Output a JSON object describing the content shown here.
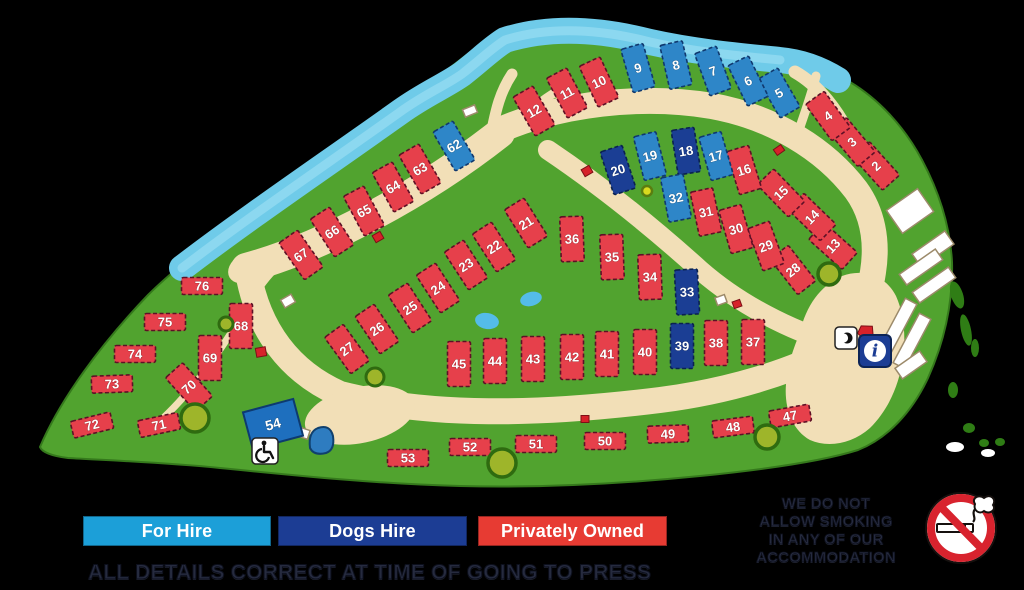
{
  "legend": {
    "items": [
      {
        "label": "For Hire",
        "chip_color": "#1C9FD8",
        "type": "forhire"
      },
      {
        "label": "Dogs Hire",
        "chip_color": "#1C3D94",
        "type": "dogshire"
      },
      {
        "label": "Privately Owned",
        "chip_color": "#E73B33",
        "type": "private"
      }
    ]
  },
  "footer_note": "ALL DETAILS CORRECT AT TIME OF GOING TO PRESS",
  "no_smoking_notice": {
    "lines": [
      "WE DO NOT",
      "ALLOW SMOKING",
      "IN ANY OF OUR",
      "ACCOMMODATION"
    ]
  },
  "facility_labels": {
    "building_54": "54"
  },
  "icons": {
    "info": "info-icon",
    "telephone": "phone-icon",
    "accessible": "wheelchair-icon",
    "no_smoking": "no-smoking-icon"
  },
  "pitch_colors": {
    "forhire": "#2E86C8",
    "dogshire": "#1B3E94",
    "private": "#E6404B"
  },
  "pitch_strokes": {
    "forhire": "#10386E",
    "dogshire": "#0A2250",
    "private": "#5E1026"
  },
  "pitch_sizes": {
    "v": {
      "w": 23,
      "h": 45
    },
    "h": {
      "w": 41,
      "h": 17
    }
  },
  "pitches": [
    {
      "n": "2",
      "x": 876,
      "y": 166,
      "r": -42,
      "t": "private",
      "o": "v"
    },
    {
      "n": "3",
      "x": 852,
      "y": 142,
      "r": -40,
      "t": "private",
      "o": "v"
    },
    {
      "n": "4",
      "x": 828,
      "y": 116,
      "r": -36,
      "t": "private",
      "o": "v"
    },
    {
      "n": "5",
      "x": 779,
      "y": 93,
      "r": -30,
      "t": "forhire",
      "o": "v"
    },
    {
      "n": "6",
      "x": 748,
      "y": 81,
      "r": -26,
      "t": "forhire",
      "o": "v"
    },
    {
      "n": "7",
      "x": 713,
      "y": 71,
      "r": -20,
      "t": "forhire",
      "o": "v"
    },
    {
      "n": "8",
      "x": 676,
      "y": 65,
      "r": -13,
      "t": "forhire",
      "o": "v"
    },
    {
      "n": "9",
      "x": 638,
      "y": 68,
      "r": -16,
      "t": "forhire",
      "o": "v"
    },
    {
      "n": "10",
      "x": 599,
      "y": 82,
      "r": -25,
      "t": "private",
      "o": "v"
    },
    {
      "n": "11",
      "x": 567,
      "y": 93,
      "r": -28,
      "t": "private",
      "o": "v"
    },
    {
      "n": "12",
      "x": 534,
      "y": 111,
      "r": -30,
      "t": "private",
      "o": "v"
    },
    {
      "n": "13",
      "x": 833,
      "y": 246,
      "r": -48,
      "t": "private",
      "o": "v"
    },
    {
      "n": "14",
      "x": 812,
      "y": 217,
      "r": -46,
      "t": "private",
      "o": "v"
    },
    {
      "n": "15",
      "x": 781,
      "y": 193,
      "r": -44,
      "t": "private",
      "o": "v"
    },
    {
      "n": "16",
      "x": 744,
      "y": 170,
      "r": -17,
      "t": "private",
      "o": "v"
    },
    {
      "n": "17",
      "x": 716,
      "y": 156,
      "r": -16,
      "t": "forhire",
      "o": "v"
    },
    {
      "n": "18",
      "x": 686,
      "y": 151,
      "r": -9,
      "t": "dogshire",
      "o": "v"
    },
    {
      "n": "19",
      "x": 650,
      "y": 156,
      "r": -14,
      "t": "forhire",
      "o": "v"
    },
    {
      "n": "20",
      "x": 618,
      "y": 170,
      "r": -18,
      "t": "dogshire",
      "o": "v"
    },
    {
      "n": "21",
      "x": 526,
      "y": 223,
      "r": -32,
      "t": "private",
      "o": "v"
    },
    {
      "n": "22",
      "x": 494,
      "y": 247,
      "r": -33,
      "t": "private",
      "o": "v"
    },
    {
      "n": "23",
      "x": 466,
      "y": 265,
      "r": -33,
      "t": "private",
      "o": "v"
    },
    {
      "n": "24",
      "x": 438,
      "y": 288,
      "r": -33,
      "t": "private",
      "o": "v"
    },
    {
      "n": "25",
      "x": 410,
      "y": 308,
      "r": -33,
      "t": "private",
      "o": "v"
    },
    {
      "n": "26",
      "x": 377,
      "y": 329,
      "r": -34,
      "t": "private",
      "o": "v"
    },
    {
      "n": "27",
      "x": 347,
      "y": 349,
      "r": -36,
      "t": "private",
      "o": "v"
    },
    {
      "n": "28",
      "x": 793,
      "y": 270,
      "r": -38,
      "t": "private",
      "o": "v"
    },
    {
      "n": "29",
      "x": 766,
      "y": 246,
      "r": -20,
      "t": "private",
      "o": "v"
    },
    {
      "n": "30",
      "x": 736,
      "y": 229,
      "r": -16,
      "t": "private",
      "o": "v"
    },
    {
      "n": "31",
      "x": 706,
      "y": 212,
      "r": -12,
      "t": "private",
      "o": "v"
    },
    {
      "n": "32",
      "x": 676,
      "y": 198,
      "r": -11,
      "t": "forhire",
      "o": "v"
    },
    {
      "n": "33",
      "x": 687,
      "y": 292,
      "r": -3,
      "t": "dogshire",
      "o": "v"
    },
    {
      "n": "34",
      "x": 650,
      "y": 277,
      "r": -2,
      "t": "private",
      "o": "v"
    },
    {
      "n": "35",
      "x": 612,
      "y": 257,
      "r": -2,
      "t": "private",
      "o": "v"
    },
    {
      "n": "36",
      "x": 572,
      "y": 239,
      "r": -2,
      "t": "private",
      "o": "v"
    },
    {
      "n": "37",
      "x": 753,
      "y": 342,
      "r": 0,
      "t": "private",
      "o": "v"
    },
    {
      "n": "38",
      "x": 716,
      "y": 343,
      "r": 0,
      "t": "private",
      "o": "v"
    },
    {
      "n": "39",
      "x": 682,
      "y": 346,
      "r": 0,
      "t": "dogshire",
      "o": "v"
    },
    {
      "n": "40",
      "x": 645,
      "y": 352,
      "r": 0,
      "t": "private",
      "o": "v"
    },
    {
      "n": "41",
      "x": 607,
      "y": 354,
      "r": 0,
      "t": "private",
      "o": "v"
    },
    {
      "n": "42",
      "x": 572,
      "y": 357,
      "r": 0,
      "t": "private",
      "o": "v"
    },
    {
      "n": "43",
      "x": 533,
      "y": 359,
      "r": 0,
      "t": "private",
      "o": "v"
    },
    {
      "n": "44",
      "x": 495,
      "y": 361,
      "r": 0,
      "t": "private",
      "o": "v"
    },
    {
      "n": "45",
      "x": 459,
      "y": 364,
      "r": 0,
      "t": "private",
      "o": "v"
    },
    {
      "n": "47",
      "x": 790,
      "y": 416,
      "r": -10,
      "t": "private",
      "o": "h"
    },
    {
      "n": "48",
      "x": 733,
      "y": 427,
      "r": -7,
      "t": "private",
      "o": "h"
    },
    {
      "n": "49",
      "x": 668,
      "y": 434,
      "r": -2,
      "t": "private",
      "o": "h"
    },
    {
      "n": "50",
      "x": 605,
      "y": 441,
      "r": 0,
      "t": "private",
      "o": "h"
    },
    {
      "n": "51",
      "x": 536,
      "y": 444,
      "r": 0,
      "t": "private",
      "o": "h"
    },
    {
      "n": "52",
      "x": 470,
      "y": 447,
      "r": 0,
      "t": "private",
      "o": "h"
    },
    {
      "n": "53",
      "x": 408,
      "y": 458,
      "r": 0,
      "t": "private",
      "o": "h"
    },
    {
      "n": "62",
      "x": 454,
      "y": 146,
      "r": -30,
      "t": "forhire",
      "o": "v"
    },
    {
      "n": "63",
      "x": 420,
      "y": 169,
      "r": -30,
      "t": "private",
      "o": "v"
    },
    {
      "n": "64",
      "x": 393,
      "y": 187,
      "r": -29,
      "t": "private",
      "o": "v"
    },
    {
      "n": "65",
      "x": 364,
      "y": 211,
      "r": -28,
      "t": "private",
      "o": "v"
    },
    {
      "n": "66",
      "x": 332,
      "y": 232,
      "r": -33,
      "t": "private",
      "o": "v"
    },
    {
      "n": "67",
      "x": 301,
      "y": 255,
      "r": -35,
      "t": "private",
      "o": "v"
    },
    {
      "n": "68",
      "x": 241,
      "y": 326,
      "r": 0,
      "t": "private",
      "o": "v"
    },
    {
      "n": "69",
      "x": 210,
      "y": 358,
      "r": 0,
      "t": "private",
      "o": "v"
    },
    {
      "n": "70",
      "x": 189,
      "y": 387,
      "r": -42,
      "t": "private",
      "o": "v"
    },
    {
      "n": "71",
      "x": 159,
      "y": 425,
      "r": -12,
      "t": "private",
      "o": "h"
    },
    {
      "n": "72",
      "x": 92,
      "y": 425,
      "r": -14,
      "t": "private",
      "o": "h"
    },
    {
      "n": "73",
      "x": 112,
      "y": 384,
      "r": -2,
      "t": "private",
      "o": "h"
    },
    {
      "n": "74",
      "x": 135,
      "y": 354,
      "r": 0,
      "t": "private",
      "o": "h"
    },
    {
      "n": "75",
      "x": 165,
      "y": 322,
      "r": 0,
      "t": "private",
      "o": "h"
    },
    {
      "n": "76",
      "x": 202,
      "y": 286,
      "r": 0,
      "t": "private",
      "o": "h"
    }
  ]
}
